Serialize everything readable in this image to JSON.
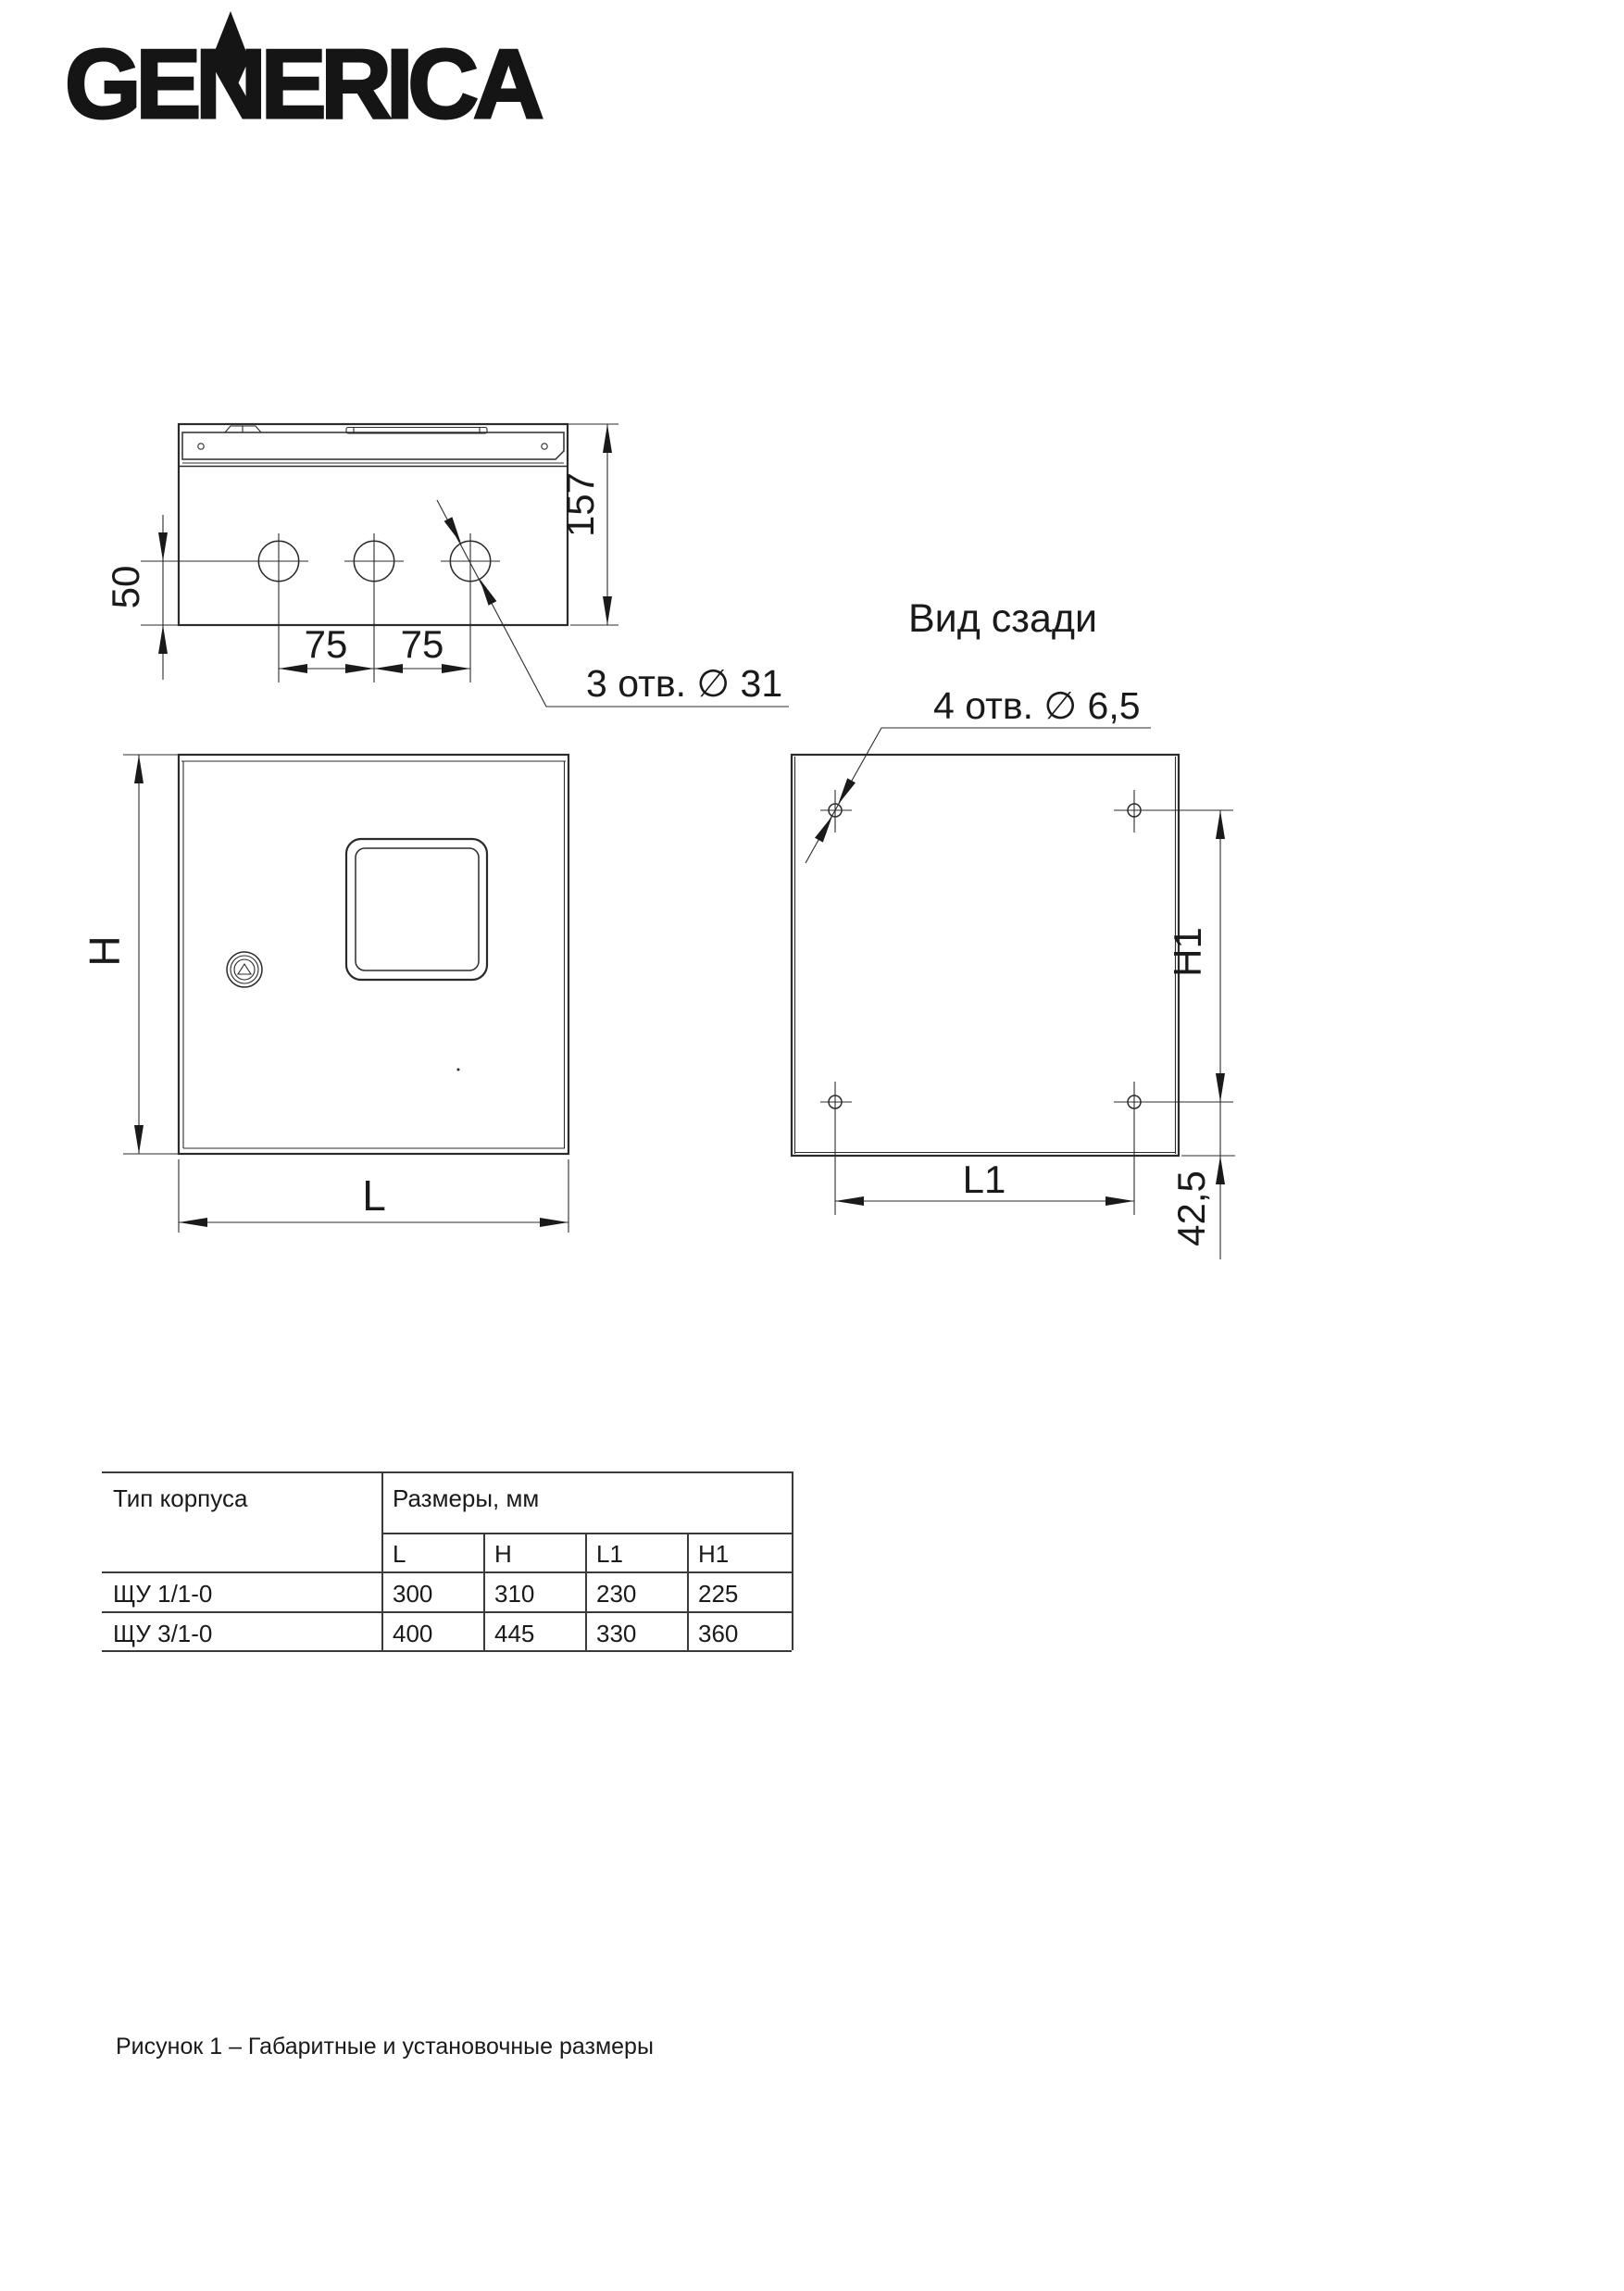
{
  "logo": {
    "text": "GENERICA"
  },
  "drawing": {
    "rear_view_title": "Вид сзади",
    "top_view": {
      "holes_label": "3 отв. ∅ 31",
      "dim_depth": "157",
      "dim_hole_offset": "50",
      "dim_spacing_1": "75",
      "dim_spacing_2": "75"
    },
    "front_view": {
      "dim_height": "H",
      "dim_width": "L"
    },
    "rear_view": {
      "holes_label": "4 отв. ∅ 6,5",
      "dim_height": "H1",
      "dim_width": "L1",
      "dim_bottom_offset": "42,5"
    }
  },
  "table": {
    "type_header": "Тип корпуса",
    "sizes_header": "Размеры, мм",
    "columns": [
      "L",
      "H",
      "L1",
      "H1"
    ],
    "rows": [
      {
        "type": "ЩУ 1/1-0",
        "values": [
          "300",
          "310",
          "230",
          "225"
        ]
      },
      {
        "type": "ЩУ 3/1-0",
        "values": [
          "400",
          "445",
          "330",
          "360"
        ]
      }
    ]
  },
  "caption": "Рисунок 1 – Габаритные и установочные размеры",
  "colors": {
    "line": "#2b2b2b",
    "text": "#1a1a1a"
  }
}
